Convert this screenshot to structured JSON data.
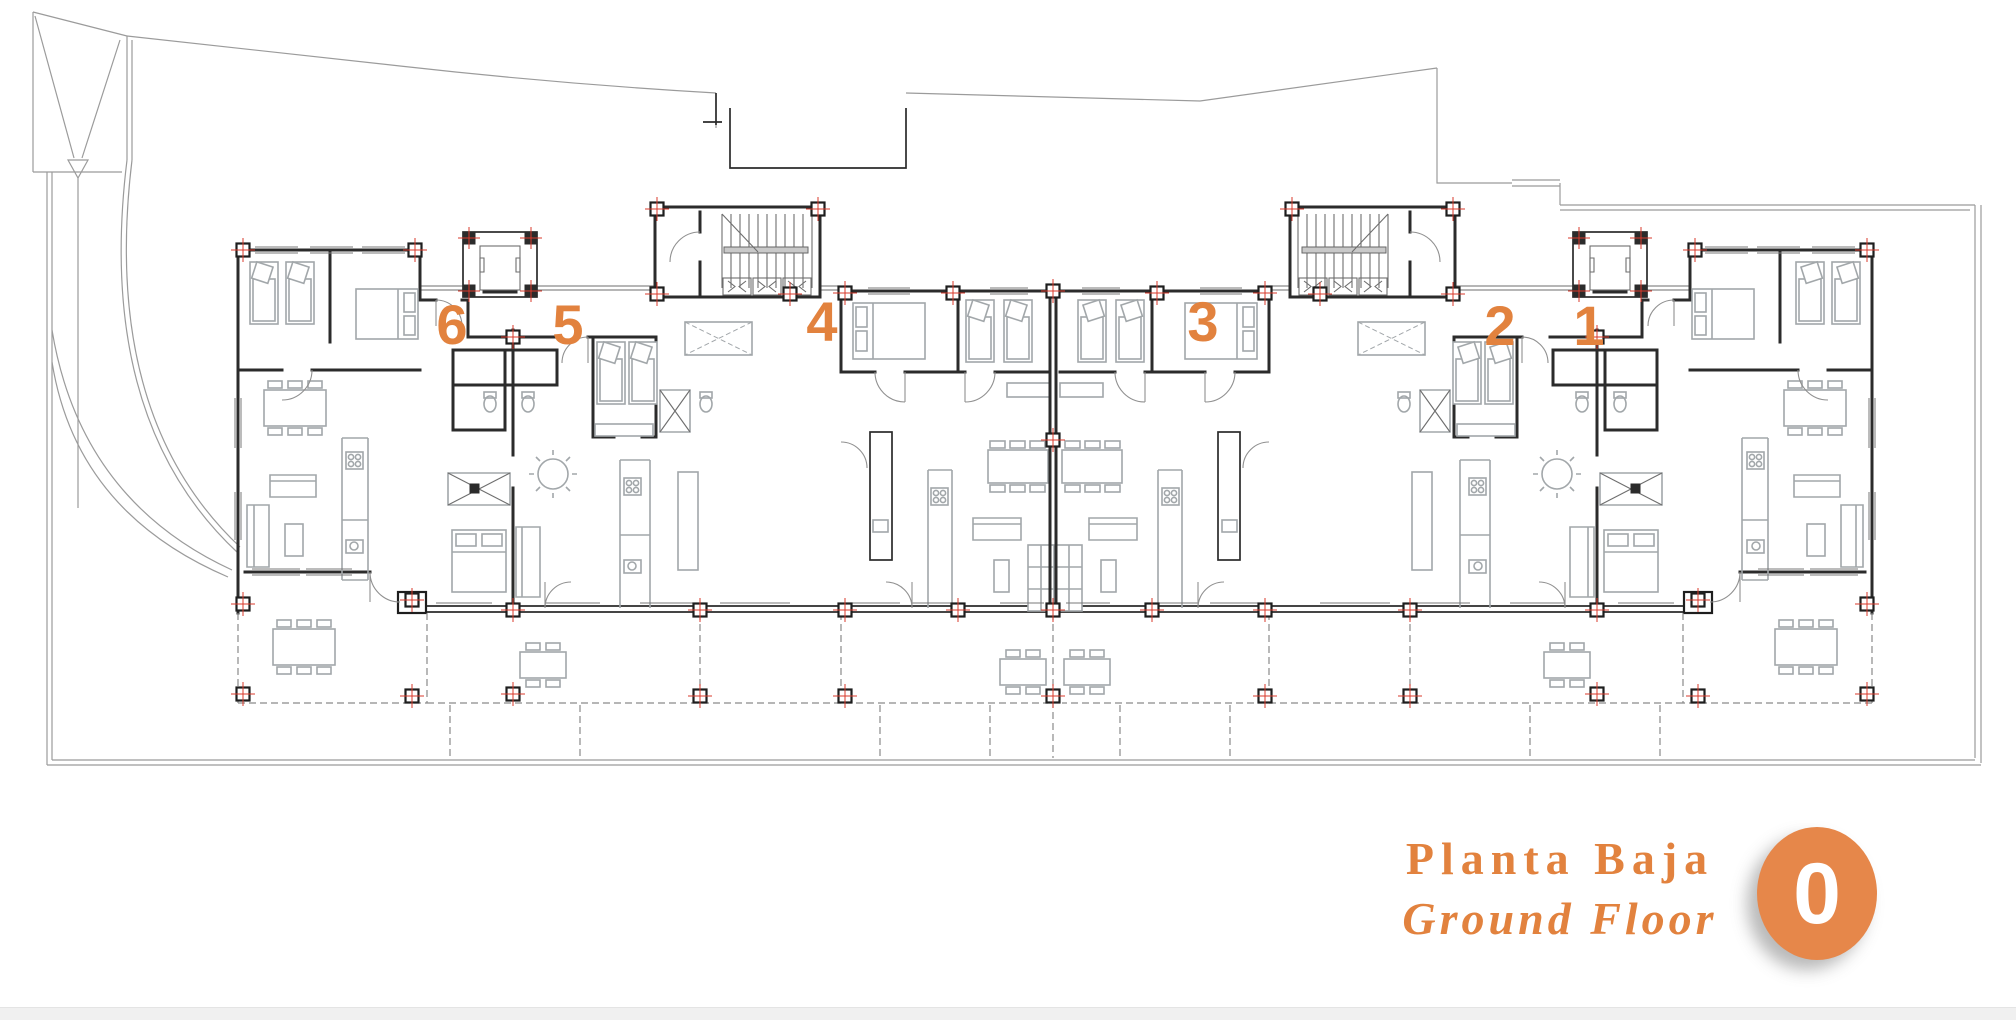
{
  "plan": {
    "floor_label_primary": "Planta Baja",
    "floor_label_secondary": "Ground Floor",
    "floor_badge": "0",
    "apartments": [
      {
        "number": "1",
        "cx": 1589,
        "cy": 328
      },
      {
        "number": "2",
        "cx": 1500,
        "cy": 328
      },
      {
        "number": "3",
        "cx": 1203,
        "cy": 324
      },
      {
        "number": "4",
        "cx": 822,
        "cy": 324
      },
      {
        "number": "5",
        "cx": 568,
        "cy": 327
      },
      {
        "number": "6",
        "cx": 452,
        "cy": 327
      }
    ]
  },
  "colors": {
    "accent": "#E2823E",
    "badge": "#E6874A",
    "wall": "#2B2B2B",
    "furniture": "#A2A7AA",
    "site_line": "#9B9B9B",
    "column_marker_red": "#D93A2B"
  }
}
